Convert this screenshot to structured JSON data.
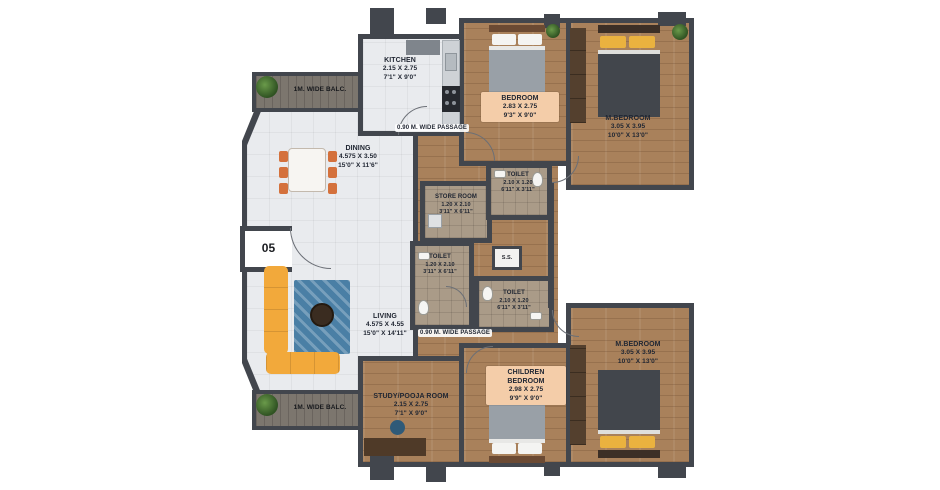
{
  "plan": {
    "unit_number": "05",
    "shaft_label": "S.S.",
    "balconies": {
      "top": "1M. WIDE BALC.",
      "bottom": "1M. WIDE BALC."
    },
    "passages": {
      "top": "0.90 M. WIDE PASSAGE",
      "bottom": "0.90 M. WIDE PASSAGE"
    },
    "rooms": {
      "kitchen": {
        "name": "KITCHEN",
        "metric": "2.15 X 2.75",
        "imperial": "7'1\" X 9'0\""
      },
      "bedroom_top": {
        "name": "BEDROOM",
        "metric": "2.83 X 2.75",
        "imperial": "9'3\" X 9'0\""
      },
      "m_bedroom_top": {
        "name": "M.BEDROOM",
        "metric": "3.05 X 3.95",
        "imperial": "10'0\" X 13'0\""
      },
      "dining": {
        "name": "DINING",
        "metric": "4.575 X 3.50",
        "imperial": "15'0\" X 11'6\""
      },
      "living": {
        "name": "LIVING",
        "metric": "4.575 X 4.55",
        "imperial": "15'0\" X 14'11\""
      },
      "toilet_top": {
        "name": "TOILET",
        "metric": "2.10 X 1.20",
        "imperial": "6'11\" X 3'11\""
      },
      "store_room": {
        "name": "STORE ROOM",
        "metric": "1.20 X 2.10",
        "imperial": "3'11\" X 6'11\""
      },
      "toilet_mid": {
        "name": "TOILET",
        "metric": "1.20 X 2.10",
        "imperial": "3'11\" X 6'11\""
      },
      "toilet_bottom": {
        "name": "TOILET",
        "metric": "2.10 X 1.20",
        "imperial": "6'11\" X 3'11\""
      },
      "study_pooja": {
        "name": "STUDY/POOJA ROOM",
        "metric": "2.15 X 2.75",
        "imperial": "7'1\" X 9'0\""
      },
      "children_bedroom": {
        "name": "CHILDREN BEDROOM",
        "metric": "2.98 X 2.75",
        "imperial": "9'9\" X 9'0\""
      },
      "m_bedroom_bottom": {
        "name": "M.BEDROOM",
        "metric": "3.05 X 3.95",
        "imperial": "10'0\" X 13'0\""
      }
    },
    "colors": {
      "wall": "#42464d",
      "wood_floor": "#a9815b",
      "tile_floor": "#aa9b88",
      "light_floor": "#e9ebee",
      "balcony_floor": "#7c766e",
      "label_box": "#f4cda9",
      "sofa": "#f2a93b",
      "rug": "#4a7fa5",
      "pillow_accent": "#eab23f",
      "chair": "#d4713c",
      "plant": "#3f6b2e"
    }
  }
}
